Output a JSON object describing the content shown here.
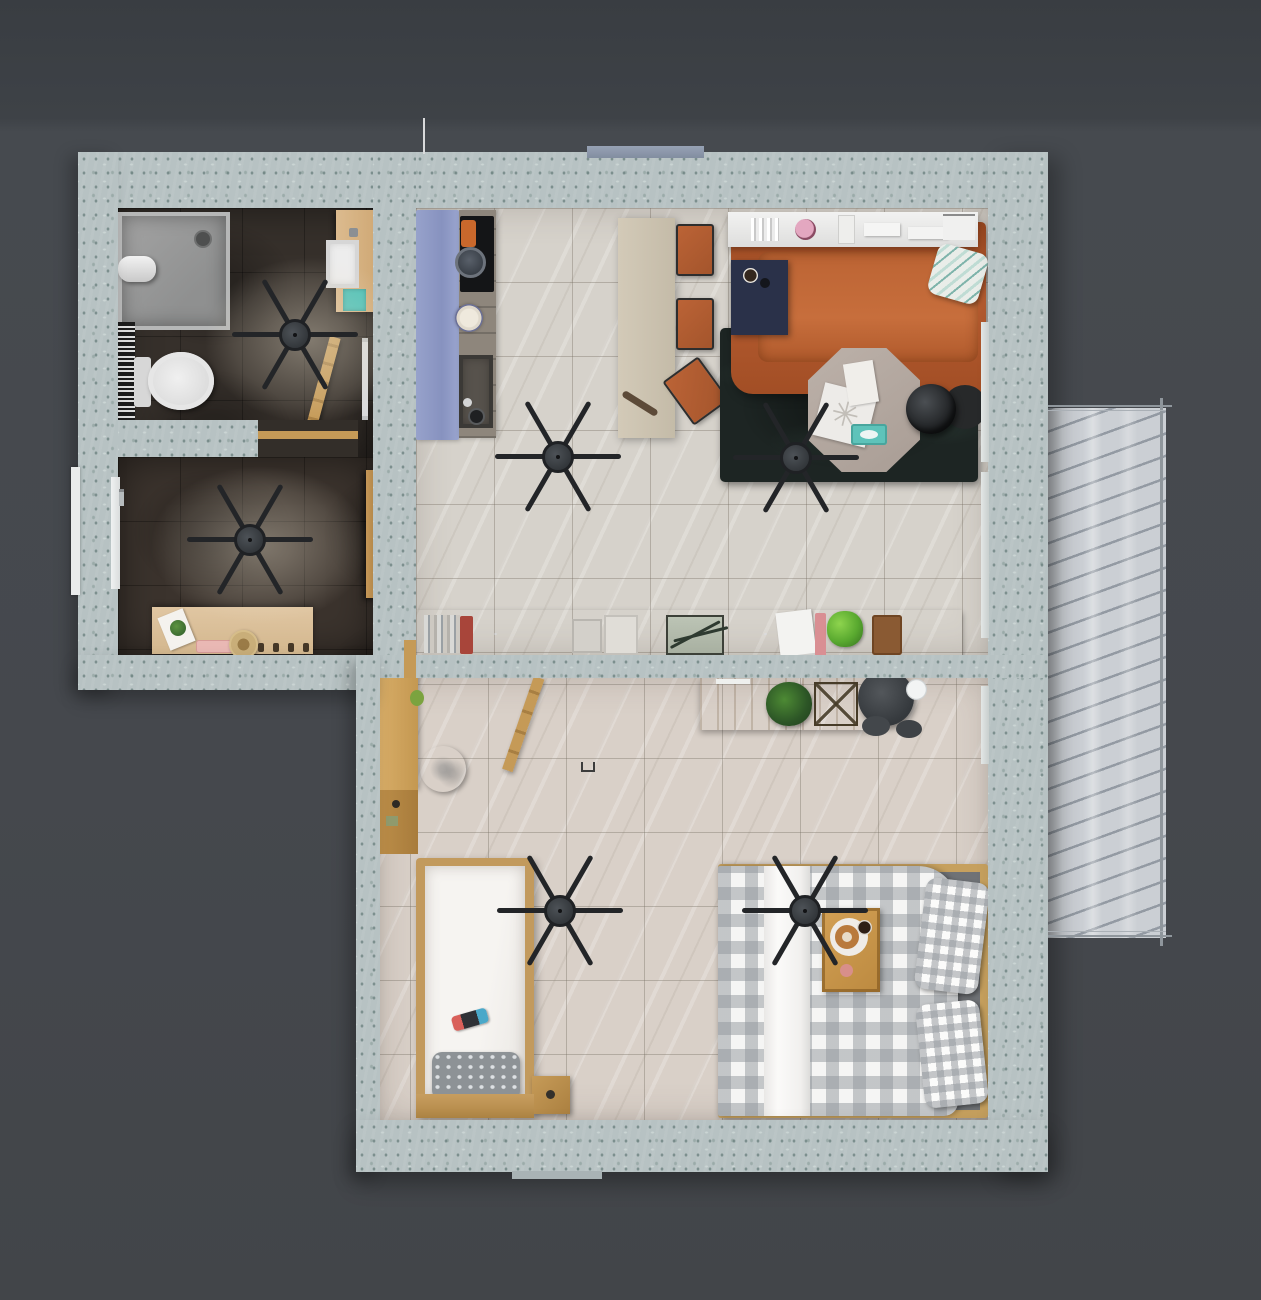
{
  "scene": {
    "title": "Apartment floor plan — rendered top-down view",
    "type": "3d-floorplan-render",
    "background_color": "#45484d",
    "wall_color": "#b7c2c3",
    "ceiling_fan_count": 6,
    "decor": {
      "snowflake_glyph": "✳"
    }
  },
  "palette": {
    "dark_floor": "#36302b",
    "light_tile_floor": "#d6d2cb",
    "bedroom_floor": "#d9d0c8",
    "balcony_floor": "#cbcfd4",
    "navy_sideboard": "#262e47",
    "leather_sofa": "#aa5329",
    "dark_rug": "#1d2523",
    "kitchen_runner": "#8e9ac6",
    "oak_wood": "#c59a57",
    "teal_accent": "#4cc1b7",
    "gingham_gray": "#96999e"
  },
  "rooms": {
    "bathroom": {
      "label": "Bathroom",
      "items": [
        "shower tray",
        "towel roll",
        "patterned bath mat",
        "toilet",
        "wooden vanity with basin",
        "teal towel",
        "leaning ladder shelf",
        "towel rail",
        "ceiling fan"
      ]
    },
    "hallway": {
      "label": "Entrance hall",
      "items": [
        "entrance door",
        "console table",
        "pink tray",
        "straw hat",
        "decor card with plant",
        "wall hooks",
        "open wooden door",
        "ceiling fan"
      ]
    },
    "kitchen": {
      "label": "Kitchen / dining",
      "items": [
        "blue runner rug",
        "counter with cooktop and sink",
        "frying pan",
        "cooking pot",
        "plate",
        "dining table",
        "three orange chairs",
        "rolling pin",
        "ceiling fan"
      ]
    },
    "living_room": {
      "label": "Living room",
      "items": [
        "white wall shelf with books and boxes",
        "leather sofa",
        "navy side table with coffee cup",
        "knit pillow",
        "dark fern rug",
        "octagonal coffee table",
        "blanket",
        "tissue box",
        "floor lamp",
        "round side table",
        "ceiling fan"
      ]
    },
    "sideboard": {
      "label": "Navy sideboard",
      "items": [
        "book row",
        "red book",
        "book stacks",
        "radio with antennas",
        "papers",
        "pink book",
        "green plant",
        "brown book"
      ]
    },
    "bedroom": {
      "label": "Bedroom",
      "items": [
        "desk with plant and wire basket",
        "office chair with mug",
        "wall rail and clothes ladder",
        "wardrobe",
        "marble round table",
        "single bed with gray pillow",
        "game controller",
        "nightstand",
        "double bed with gingham duvet",
        "checkered pillows",
        "breakfast tray with donut and coffee",
        "two ceiling fans"
      ]
    },
    "balcony": {
      "label": "Balcony",
      "items": [
        "slatted shadow floor",
        "metal railing"
      ]
    }
  }
}
